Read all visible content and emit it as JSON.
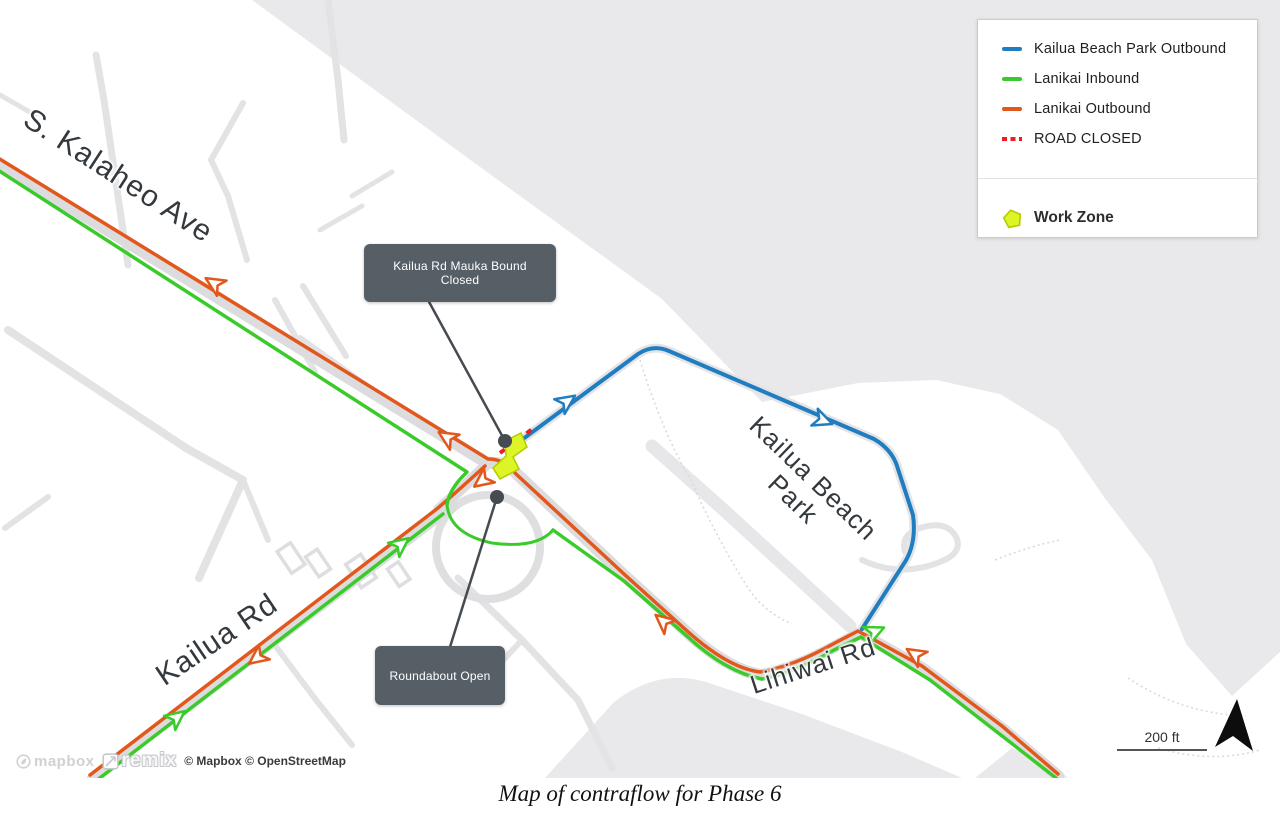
{
  "page": {
    "caption": "Map of contraflow for Phase 6"
  },
  "legend": {
    "items": [
      {
        "name": "kailua-beach-park-outbound",
        "label": "Kailua Beach Park Outbound",
        "color": "#1f7dc0",
        "style": "solid"
      },
      {
        "name": "lanikai-inbound",
        "label": "Lanikai Inbound",
        "color": "#3acb2a",
        "style": "solid"
      },
      {
        "name": "lanikai-outbound",
        "label": "Lanikai Outbound",
        "color": "#e2571c",
        "style": "solid"
      },
      {
        "name": "road-closed",
        "label": "ROAD CLOSED",
        "color": "#ee1c23",
        "style": "dashed"
      }
    ],
    "work_zone": {
      "label": "Work Zone",
      "fill": "#ddf427",
      "stroke": "#b3cc00"
    }
  },
  "map": {
    "colors": {
      "orange": "#e2571c",
      "green": "#3acb2a",
      "blue": "#1f7dc0",
      "red": "#ee1c23"
    },
    "road_labels": [
      {
        "name": "s-kalaheo-ave",
        "text": "S. Kalaheo Ave",
        "x": 118,
        "y": 176,
        "rotate": 33,
        "size": 30
      },
      {
        "name": "kailua-rd",
        "text": "Kailua Rd",
        "x": 217,
        "y": 640,
        "rotate": -34,
        "size": 30
      },
      {
        "name": "kailua-beach-park",
        "text": "Kailua Beach\nPark",
        "x": 803,
        "y": 489,
        "rotate": 44,
        "size": 26
      },
      {
        "name": "lihiwai-rd",
        "text": "Lihiwai Rd",
        "x": 813,
        "y": 666,
        "rotate": -18,
        "size": 26
      }
    ],
    "callouts": [
      {
        "name": "kailua-rd-mauka-bound-closed",
        "text": "Kailua Rd Mauka Bound Closed",
        "box": {
          "x": 364,
          "y": 244,
          "w": 192,
          "h": 58
        },
        "leader": {
          "x1": 428,
          "y1": 300,
          "x2": 505,
          "y2": 441
        },
        "dot": {
          "x": 505,
          "y": 441
        }
      },
      {
        "name": "roundabout-open",
        "text": "Roundabout Open",
        "box": {
          "x": 375,
          "y": 646,
          "w": 130,
          "h": 59
        },
        "leader": {
          "x1": 450,
          "y1": 647,
          "x2": 497,
          "y2": 497
        },
        "dot": {
          "x": 497,
          "y": 497
        }
      }
    ],
    "routes": [
      {
        "name": "lanikai-outbound-main",
        "color": "orange",
        "width": 3.5,
        "path": "M -10 153 L 488 459 Q 505 459 516 474 L 624 574 L 686 630 Q 728 668 760 672 Q 792 667 833 644 L 858 631 L 922 666 L 1002 726 L 1058 774"
      },
      {
        "name": "lanikai-outbound-kailua-branch",
        "color": "orange",
        "width": 3.5,
        "path": "M 485 466 Q 460 489 438 508 L 90 775"
      },
      {
        "name": "lanikai-inbound-kalaheo",
        "color": "green",
        "width": 3.5,
        "path": "M -10 165 L 467 472 Q 449 489 447 505"
      },
      {
        "name": "lanikai-inbound-roundabout-loop",
        "color": "green",
        "width": 3,
        "path": "M 447 505 Q 450 534 492 543 Q 537 549 553 530"
      },
      {
        "name": "lanikai-inbound-lihiwai",
        "color": "green",
        "width": 3.5,
        "path": "M 553 530 L 624 581 L 688 637 Q 726 672 762 679 Q 794 673 834 650 L 861 637 L 930 680 L 1006 739 L 1056 778"
      },
      {
        "name": "lanikai-inbound-kailua",
        "color": "green",
        "width": 3.5,
        "path": "M 96 781 L 443 514"
      },
      {
        "name": "kailua-beach-park-outbound",
        "color": "blue",
        "width": 4,
        "path": "M 523 439 L 638 354 Q 653 344 669 351 L 874 439 Q 893 450 898 469 L 913 515 Q 917 545 903 565 L 862 629"
      },
      {
        "name": "road-closed",
        "color": "red",
        "width": 4,
        "dasharray": "6 5",
        "path": "M 500 453 L 535 427"
      }
    ],
    "work_zone_points": "505,441 521,433 527,447 513,457 519,469 500,479 493,468 506,456",
    "arrows": [
      {
        "color": "orange",
        "x": 215,
        "y": 284,
        "rotate": -58
      },
      {
        "color": "orange",
        "x": 448,
        "y": 438,
        "rotate": -58
      },
      {
        "color": "orange",
        "x": 483,
        "y": 480,
        "rotate": 233
      },
      {
        "color": "orange",
        "x": 258,
        "y": 657,
        "rotate": 233
      },
      {
        "color": "green",
        "x": 176,
        "y": 718,
        "rotate": 52
      },
      {
        "color": "green",
        "x": 400,
        "y": 545,
        "rotate": 52
      },
      {
        "color": "orange",
        "x": 664,
        "y": 622,
        "rotate": 310
      },
      {
        "color": "green",
        "x": 874,
        "y": 632,
        "rotate": 66
      },
      {
        "color": "orange",
        "x": 916,
        "y": 655,
        "rotate": 303
      },
      {
        "color": "blue",
        "x": 566,
        "y": 402,
        "rotate": 55
      },
      {
        "color": "blue",
        "x": 822,
        "y": 420,
        "rotate": 111
      }
    ],
    "scale": {
      "label": "200 ft"
    },
    "attribution": {
      "mapbox": "mapbox",
      "remix": "remix",
      "text": "© Mapbox © OpenStreetMap"
    }
  }
}
